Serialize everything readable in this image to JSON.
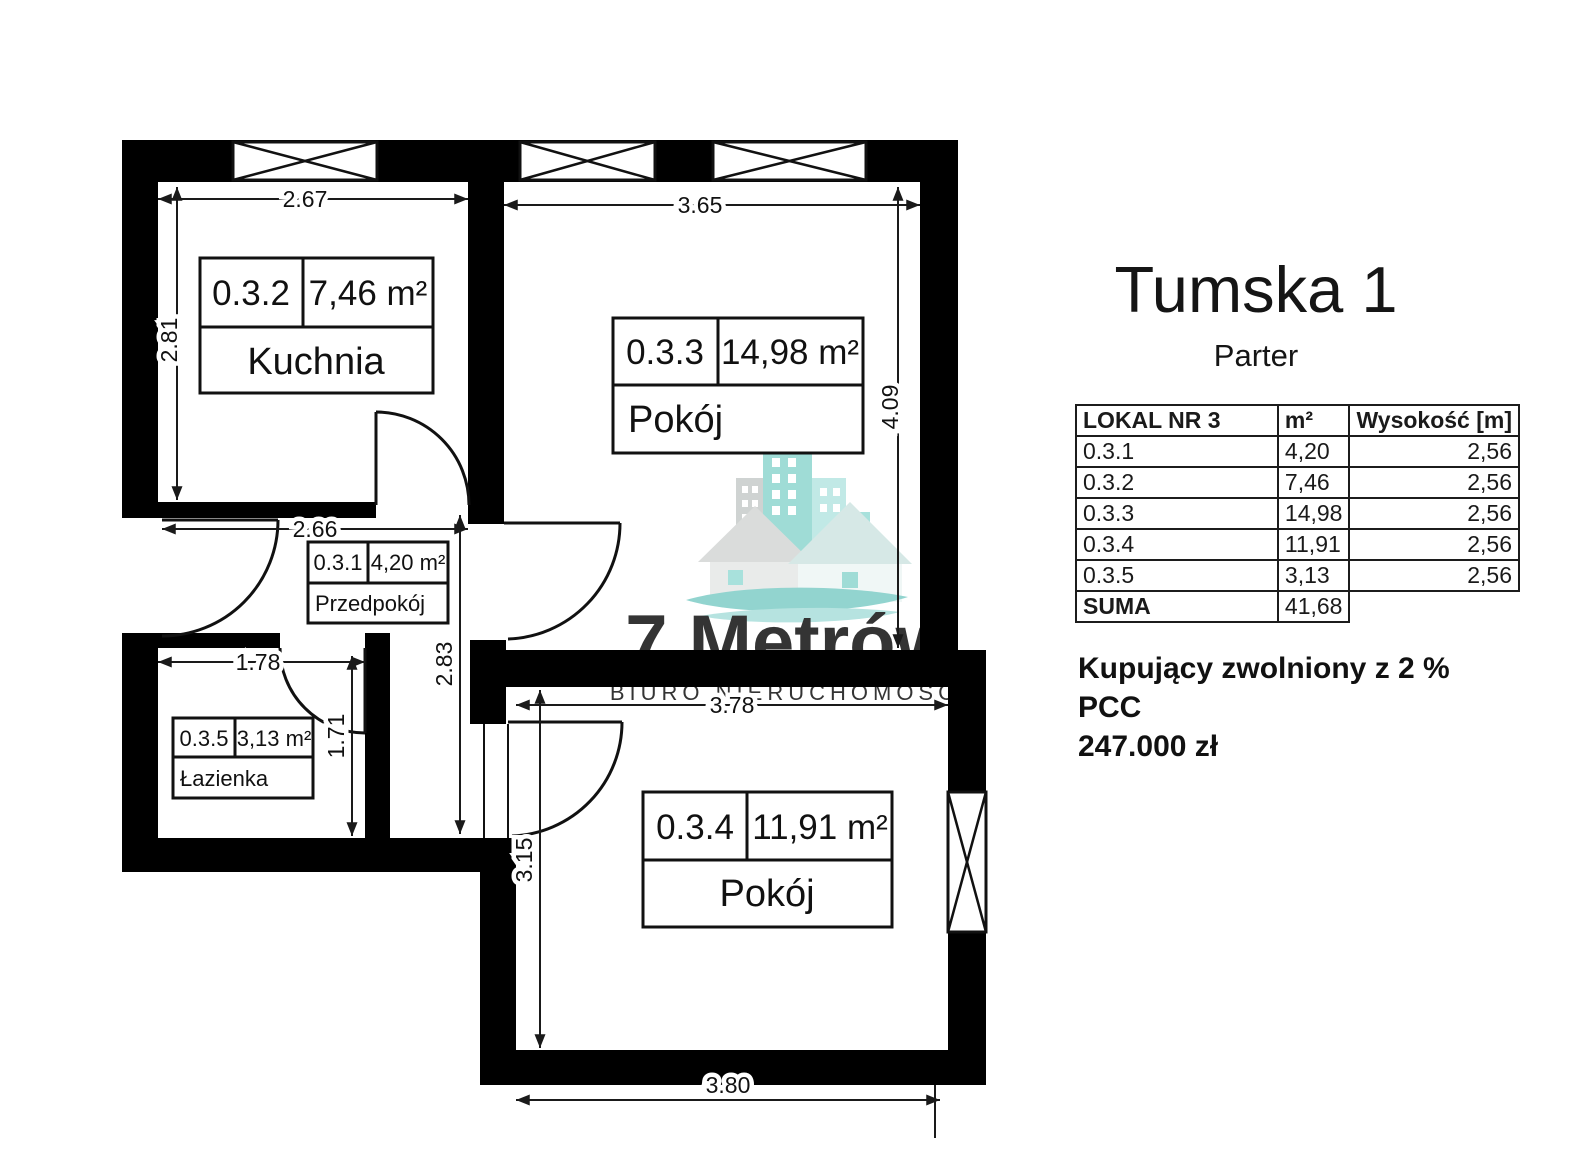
{
  "title": "Tumska 1",
  "subtitle": "Parter",
  "table": {
    "headers": [
      "LOKAL NR 3",
      "m²",
      "Wysokość [m]"
    ],
    "rows": [
      {
        "id": "0.3.1",
        "area": "4,20",
        "height": "2,56"
      },
      {
        "id": "0.3.2",
        "area": "7,46",
        "height": "2,56"
      },
      {
        "id": "0.3.3",
        "area": "14,98",
        "height": "2,56"
      },
      {
        "id": "0.3.4",
        "area": "11,91",
        "height": "2,56"
      },
      {
        "id": "0.3.5",
        "area": "3,13",
        "height": "2,56"
      }
    ],
    "suma_label": "SUMA",
    "suma_value": "41,68"
  },
  "notes": {
    "line1": "Kupujący zwolniony z 2 % PCC",
    "line2": "247.000 zł"
  },
  "watermark": {
    "name": "7 Metrów",
    "tagline": "BIURO NIERUCHOMOŚCI"
  },
  "rooms": [
    {
      "id": "0.3.2",
      "area": "7,46 m²",
      "name": "Kuchnia"
    },
    {
      "id": "0.3.3",
      "area": "14,98 m²",
      "name": "Pokój"
    },
    {
      "id": "0.3.1",
      "area": "4,20 m²",
      "name": "Przedpokój"
    },
    {
      "id": "0.3.5",
      "area": "3,13 m²",
      "name": "Łazienka"
    },
    {
      "id": "0.3.4",
      "area": "11,91 m²",
      "name": "Pokój"
    }
  ],
  "dims": {
    "kuchnia_w": "2.67",
    "kuchnia_h": "2.81",
    "pokoj_033_w": "3.65",
    "pokoj_033_h": "4.09",
    "przedpokoj_w": "2.66",
    "przedpokoj_h": "2.83",
    "lazienka_w": "1.78",
    "lazienka_h": "1.71",
    "pokoj_034_w": "3.78",
    "pokoj_034_h": "3.15",
    "pokoj_034_bottom": "3.80"
  },
  "colors": {
    "wall": "#000000",
    "line": "#1a1a1a",
    "watermark_teal": "#8fd6d0",
    "watermark_gray": "#c3c3c3"
  }
}
